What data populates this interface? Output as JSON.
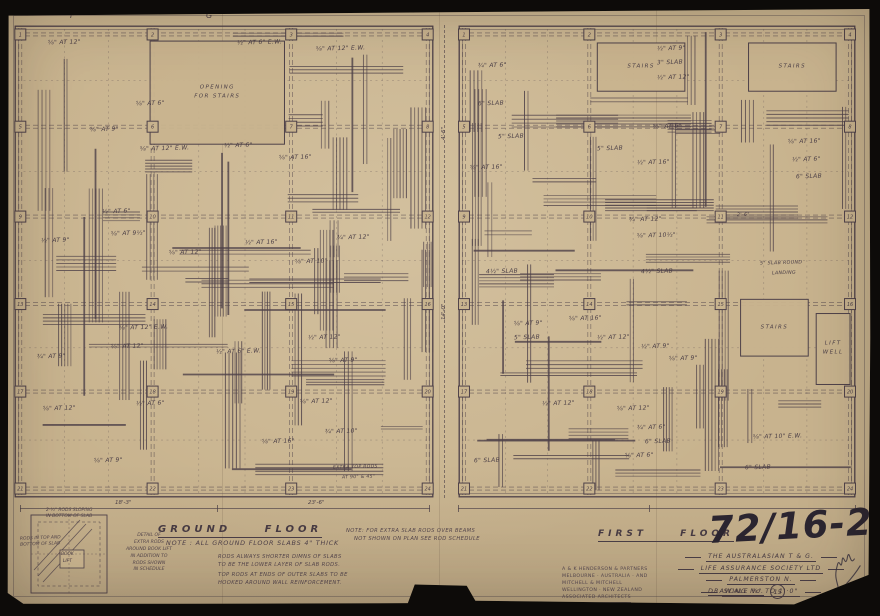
{
  "colors": {
    "paper": "#c8b38e",
    "ink": "#4e4149",
    "ink_soft": "#6a5c5e",
    "black": "#0d0b09",
    "pencil": "#2b2530"
  },
  "drawing_number": "72/16-22",
  "grid_letters": [
    {
      "label": "F",
      "x": 64
    },
    {
      "label": "G",
      "x": 200
    }
  ],
  "dims": {
    "gf_bottom": [
      {
        "t": "18'-3\"",
        "x": 95
      },
      {
        "t": "23'-6\"",
        "x": 288
      }
    ],
    "gap": [
      {
        "t": "4'-6\"",
        "y": 115
      },
      {
        "t": "14'-0\"",
        "y": 295
      }
    ]
  },
  "plans": [
    {
      "id": "ground-floor",
      "seed": 7,
      "bars": 58,
      "beams": 10,
      "cols_pct": [
        1.5,
        33,
        66,
        98.5
      ],
      "rows_pct": [
        2,
        21.5,
        40.5,
        59,
        77.5,
        98
      ],
      "openings": [
        {
          "x": 32.4,
          "y": 3.4,
          "w": 32,
          "h": 21.8,
          "label": [
            "OPENING",
            "FOR STAIRS"
          ]
        }
      ],
      "annotations": [
        {
          "t": "⅝\" AT 12\"",
          "x": 8,
          "y": 3.2
        },
        {
          "t": "½\" AT 6\" E.W.",
          "x": 53,
          "y": 3.2
        },
        {
          "t": "⅝\" AT 12\" E.W.",
          "x": 72,
          "y": 4.4
        },
        {
          "t": "⅝\" AT 6\"",
          "x": 29,
          "y": 16
        },
        {
          "t": "⅝\" AT 9\"",
          "x": 18,
          "y": 21.5
        },
        {
          "t": "⅝\" AT 12\" E.W.",
          "x": 30,
          "y": 25.5
        },
        {
          "t": "½\" AT 6\"",
          "x": 50,
          "y": 25
        },
        {
          "t": "⅝\" AT 16\"",
          "x": 63,
          "y": 27.5
        },
        {
          "t": "½\" AT 9\"",
          "x": 6.5,
          "y": 45
        },
        {
          "t": "½\" AT 6\"",
          "x": 21,
          "y": 39
        },
        {
          "t": "⅝\" AT 9½\"",
          "x": 23,
          "y": 43.5
        },
        {
          "t": "⅝\" AT 12\"",
          "x": 37,
          "y": 47.5
        },
        {
          "t": "½\" AT 16\"",
          "x": 55,
          "y": 45.5
        },
        {
          "t": "¾\" AT 12\"",
          "x": 77,
          "y": 44.5
        },
        {
          "t": "⅝\" AT 10\"",
          "x": 67,
          "y": 49.5
        },
        {
          "t": "⅝\" AT 12\" E.W.",
          "x": 25,
          "y": 63.5
        },
        {
          "t": "⅝\" AT 12\"",
          "x": 23,
          "y": 67.5
        },
        {
          "t": "¾\" AT 9\"",
          "x": 5.5,
          "y": 69.5
        },
        {
          "t": "½\" AT 6\" E.W.",
          "x": 48,
          "y": 68.5
        },
        {
          "t": "½\" AT 12\"",
          "x": 70,
          "y": 65.5
        },
        {
          "t": "⅝\" AT 9\"",
          "x": 75,
          "y": 70.5
        },
        {
          "t": "⅝\" AT 12\"",
          "x": 7,
          "y": 80.5
        },
        {
          "t": "½\" AT 6\"",
          "x": 29,
          "y": 79.5
        },
        {
          "t": "⅝\" AT 12\"",
          "x": 68,
          "y": 79
        },
        {
          "t": "¾\" AT 10\"",
          "x": 74,
          "y": 85.5
        },
        {
          "t": "⅝\" AT 16\"",
          "x": 59,
          "y": 87.5
        },
        {
          "t": "⅝\" AT 9\"",
          "x": 19,
          "y": 91.5
        },
        {
          "t": "EXTRA TOP RODS",
          "x": 76,
          "y": 93.2,
          "s": 4.6
        },
        {
          "t": "AT 90° & 45°",
          "x": 78,
          "y": 95.4,
          "s": 4.6
        }
      ]
    },
    {
      "id": "first-floor",
      "seed": 23,
      "bars": 58,
      "beams": 10,
      "cols_pct": [
        1.5,
        33,
        66,
        98.5
      ],
      "rows_pct": [
        2,
        21.5,
        40.5,
        59,
        77.5,
        98
      ],
      "openings": [
        {
          "x": 35,
          "y": 3.8,
          "w": 22,
          "h": 10.2,
          "label": [
            "STAIRS"
          ]
        },
        {
          "x": 73,
          "y": 3.8,
          "w": 22,
          "h": 10.2,
          "label": [
            "STAIRS"
          ]
        },
        {
          "x": 71,
          "y": 58,
          "w": 17,
          "h": 12,
          "label": [
            "STAIRS"
          ]
        },
        {
          "x": 90,
          "y": 61,
          "w": 8.5,
          "h": 15,
          "label": [
            "LIFT",
            "WELL"
          ]
        }
      ],
      "annotations": [
        {
          "t": "½\" AT 9\"",
          "x": 50,
          "y": 4.5
        },
        {
          "t": "3\" SLAB",
          "x": 50,
          "y": 7.5
        },
        {
          "t": "½\" AT 12\"",
          "x": 50,
          "y": 10.5
        },
        {
          "t": "¾\" AT 6\"",
          "x": 5,
          "y": 8
        },
        {
          "t": "6\" SLAB",
          "x": 5,
          "y": 16
        },
        {
          "t": "5\" SLAB",
          "x": 10,
          "y": 23
        },
        {
          "t": "⅝\" AT 16\"",
          "x": 3,
          "y": 29.5
        },
        {
          "t": "5\" SLAB",
          "x": 35,
          "y": 25.5
        },
        {
          "t": "½\" AT 16\"",
          "x": 45,
          "y": 28.5
        },
        {
          "t": "⅝\" AT 6\"",
          "x": 49,
          "y": 21
        },
        {
          "t": "⅝\" AT 16\"",
          "x": 83,
          "y": 24
        },
        {
          "t": "½\" AT 6\"",
          "x": 84,
          "y": 28
        },
        {
          "t": "6\" SLAB",
          "x": 85,
          "y": 31.5
        },
        {
          "t": "¾\" AT 12\"",
          "x": 43,
          "y": 40.5
        },
        {
          "t": "⅝\" AT 10½\"",
          "x": 45,
          "y": 44
        },
        {
          "t": "2'-6\"",
          "x": 70,
          "y": 40,
          "s": 4.8
        },
        {
          "t": "4½\" SLAB",
          "x": 7,
          "y": 51.5
        },
        {
          "t": "4½\" SLAB",
          "x": 46,
          "y": 51.5
        },
        {
          "t": "5\" SLAB ROUND",
          "x": 76,
          "y": 50,
          "s": 4.8
        },
        {
          "t": "LANDING",
          "x": 79,
          "y": 52.3,
          "s": 4.8
        },
        {
          "t": "⅝\" AT 9\"",
          "x": 14,
          "y": 62.5
        },
        {
          "t": "5\" SLAB",
          "x": 14,
          "y": 65.5
        },
        {
          "t": "⅝\" AT 16\"",
          "x": 28,
          "y": 61.5
        },
        {
          "t": "½\" AT 12\"",
          "x": 35,
          "y": 65.5
        },
        {
          "t": "½\" AT 9\"",
          "x": 46,
          "y": 67.5
        },
        {
          "t": "⅝\" AT 9\"",
          "x": 53,
          "y": 70
        },
        {
          "t": "½\" AT 12\"",
          "x": 21,
          "y": 79.5
        },
        {
          "t": "⅝\" AT 12\"",
          "x": 40,
          "y": 80.5
        },
        {
          "t": "¾\" AT 6\"",
          "x": 45,
          "y": 84.5
        },
        {
          "t": "6\" SLAB",
          "x": 47,
          "y": 87.5
        },
        {
          "t": "⅝\" AT 6\"",
          "x": 42,
          "y": 90.5
        },
        {
          "t": "⅝\" AT 10\" E.W.",
          "x": 74,
          "y": 86.5
        },
        {
          "t": "6\" SLAB",
          "x": 4,
          "y": 91.5
        },
        {
          "t": "6\" SLAB",
          "x": 72,
          "y": 93
        }
      ]
    }
  ],
  "footer": {
    "gf_title": "GROUND FLOOR",
    "ff_title": "FIRST FLOOR",
    "note_main": "NOTE :   ALL GROUND FLOOR SLABS 4\" THICK",
    "note_sub1a": "RODS ALWAYS SHORTER DIMNS OF SLABS",
    "note_sub1b": "TO BE THE LOWER LAYER OF SLAB RODS.",
    "note_sub2a": "TOP RODS AT ENDS OF OUTER SLABS TO BE",
    "note_sub2b": "HOOKED AROUND WALL REINFORCEMENT.",
    "note_right1": "NOTE:  FOR EXTRA SLAB RODS OVER BEAMS",
    "note_right2": "NOT SHOWN ON PLAN SEE ROD SCHEDULE"
  },
  "detail": {
    "note_top1": "2-½\" RODS SLOPING",
    "note_top2": "IN BOTTOM OF SLAB",
    "note_left1": "RODS IN TOP AND",
    "note_left2": "BOTTOM OF SLAB",
    "box_label1": "BOOK",
    "box_label2": "LIFT",
    "caption": [
      "DETAIL OF",
      "EXTRA RODS",
      "AROUND BOOK LIFT",
      "IN ADDITION TO",
      "RODS SHOWN",
      "IN SCHEDULE"
    ]
  },
  "title_block": {
    "client_line1": "THE AUSTRALASIAN T & G.",
    "client_line2": "LIFE ASSURANCE SOCIETY LTD",
    "location": "PALMERSTON N.",
    "scale": "SCALE ⅛\" TO 1'·0\"",
    "drawing_label": "DRAWING No.",
    "drawing_no": "15",
    "firm": [
      "A & K HENDERSON & PARTNERS",
      "MELBOURNE · AUSTRALIA · AND",
      "MITCHELL & MITCHELL",
      "WELLINGTON · NEW ZEALAND",
      "ASSOCIATED ARCHITECTS"
    ]
  }
}
